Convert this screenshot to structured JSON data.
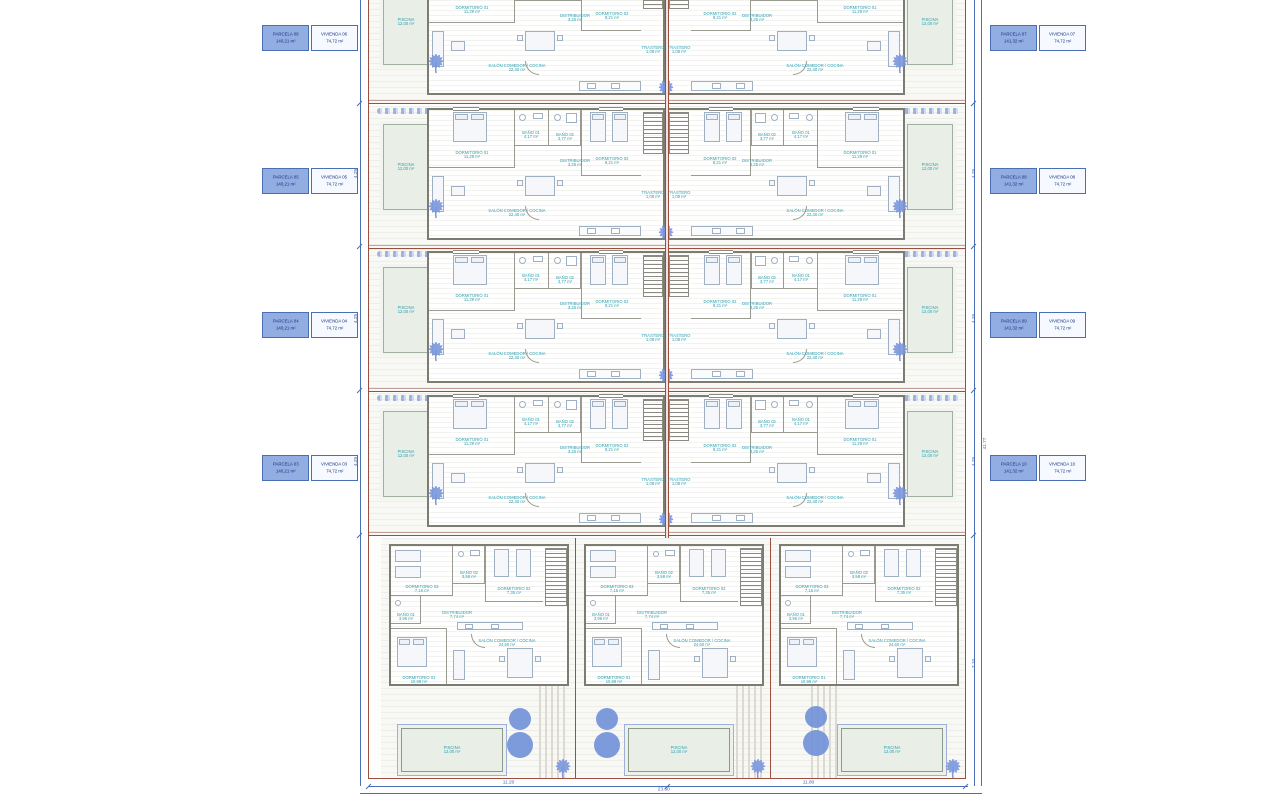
{
  "title": "Plano de parcelas y viviendas",
  "colors": {
    "plot_boundary": "#9b4f3f",
    "dimension_blue": "#4a6fb5",
    "room_text_teal": "#2f9fae",
    "vegetation_blue": "#7b97dd",
    "label_fill_blue": "#92ade2",
    "pool_fill": "#e9efe7"
  },
  "labels": {
    "left": [
      {
        "p": "PARCELA 06",
        "pa": "140,21 m²",
        "v": "VIVIENDA 06",
        "va": "74,72 m²"
      },
      {
        "p": "PARCELA 05",
        "pa": "140,21 m²",
        "v": "VIVIENDA 05",
        "va": "74,72 m²"
      },
      {
        "p": "PARCELA 04",
        "pa": "140,21 m²",
        "v": "VIVIENDA 04",
        "va": "74,72 m²"
      },
      {
        "p": "PARCELA 03",
        "pa": "140,21 m²",
        "v": "VIVIENDA 03",
        "va": "74,72 m²"
      }
    ],
    "right": [
      {
        "p": "PARCELA 07",
        "pa": "141,32 m²",
        "v": "VIVIENDA 07",
        "va": "74,72 m²"
      },
      {
        "p": "PARCELA 08",
        "pa": "141,32 m²",
        "v": "VIVIENDA 08",
        "va": "74,72 m²"
      },
      {
        "p": "PARCELA 09",
        "pa": "141,32 m²",
        "v": "VIVIENDA 09",
        "va": "74,72 m²"
      },
      {
        "p": "PARCELA 10",
        "pa": "141,32 m²",
        "v": "VIVIENDA 10",
        "va": "74,72 m²"
      }
    ]
  },
  "pool": {
    "name": "PISCINA",
    "size": "12,00 m²"
  },
  "unit": {
    "rooms": {
      "dorm1": "DORMITORIO 01",
      "dorm1_a": "11,29 m²",
      "dorm2": "DORMITORIO 02",
      "dorm2_a": "8,21 m²",
      "bano1": "BAÑO 01",
      "bano1_a": "4,17 m²",
      "bano2": "BAÑO 02",
      "bano2_a": "3,77 m²",
      "dist": "DISTRIBUIDOR",
      "dist_a": "3,25 m²",
      "salon": "SALÓN COMEDOR / COCINA",
      "salon_a": "22,40 m²",
      "trastero": "TRASTERO",
      "trastero_a": "1,08 m²"
    }
  },
  "bunit": {
    "rooms": {
      "dorm1": "DORMITORIO 01",
      "dorm1_a": "10,98 m²",
      "dorm2": "DORMITORIO 02",
      "dorm2_a": "7,35 m²",
      "dorm3": "DORMITORIO 03",
      "dorm3_a": "7,16 m²",
      "bano1": "BAÑO 01",
      "bano1_a": "3,96 m²",
      "bano2": "BAÑO 02",
      "bano2_a": "3,58 m²",
      "dist": "DISTRIBUIDOR",
      "dist_a": "7,74 m²",
      "salon": "SALÓN COMEDOR / COCINA",
      "salon_a": "24,60 m²"
    }
  },
  "dims": {
    "bottom_seg1": "11.20",
    "bottom_seg2": "11.80",
    "bottom_total": "23.60",
    "row_tick": "4.25",
    "side_total": "41.77",
    "side_bottom": "7.10"
  }
}
